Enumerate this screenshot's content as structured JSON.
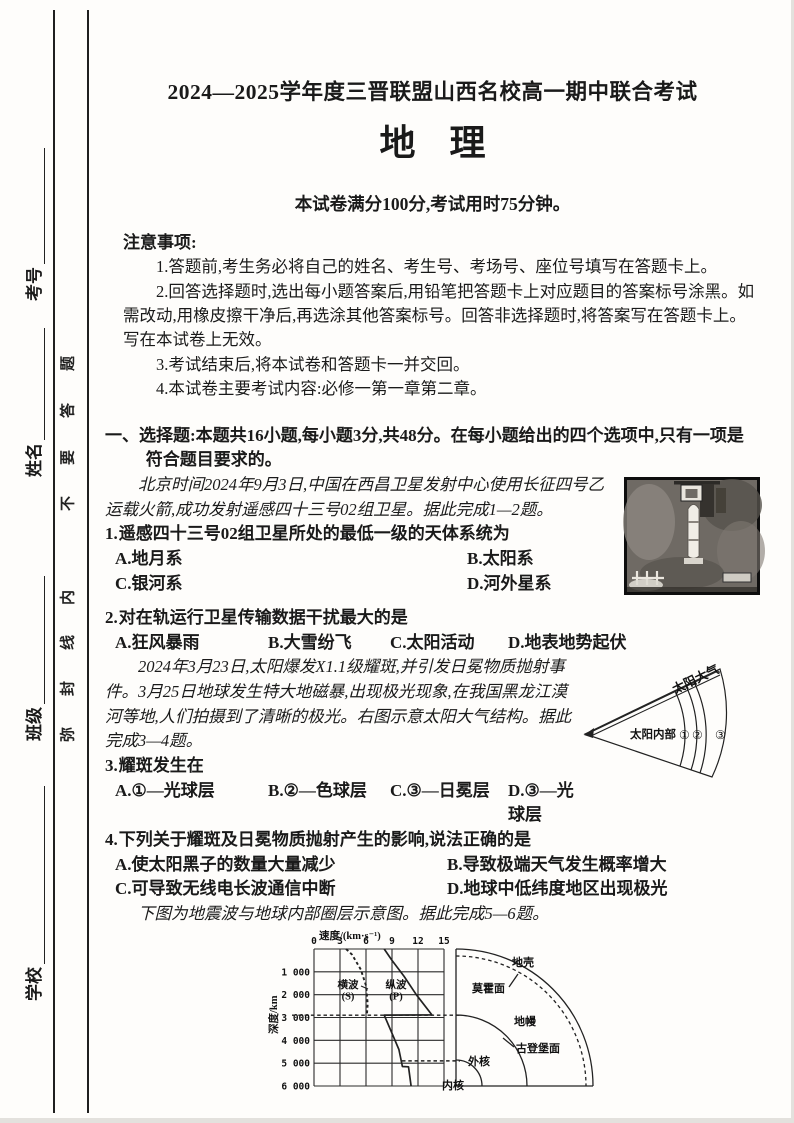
{
  "sidebar": {
    "seal_phrase": "弥封线内不要答题",
    "seal_chars": [
      "题",
      "答",
      "要",
      "不",
      "内",
      "线",
      "封",
      "弥"
    ],
    "fields": [
      {
        "label": "考号"
      },
      {
        "label": "姓名"
      },
      {
        "label": "班级"
      },
      {
        "label": "学校"
      }
    ]
  },
  "header": {
    "exam_title": "2024—2025学年度三晋联盟山西名校高一期中联合考试",
    "subject": "地理",
    "exam_info": "本试卷满分100分,考试用时75分钟。"
  },
  "notice": {
    "title": "注意事项:",
    "items": [
      "1.答题前,考生务必将自己的姓名、考生号、考场号、座位号填写在答题卡上。",
      "2.回答选择题时,选出每小题答案后,用铅笔把答题卡上对应题目的答案标号涂黑。如需改动,用橡皮擦干净后,再选涂其他答案标号。回答非选择题时,将答案写在答题卡上。写在本试卷上无效。",
      "3.考试结束后,将本试卷和答题卡一并交回。",
      "4.本试卷主要考试内容:必修一第一章第二章。"
    ]
  },
  "section": {
    "heading": "一、选择题:本题共16小题,每小题3分,共48分。在每小题给出的四个选项中,只有一项是符合题目要求的。"
  },
  "passages": [
    "北京时间2024年9月3日,中国在西昌卫星发射中心使用长征四号乙运载火箭,成功发射遥感四十三号02组卫星。据此完成1—2题。",
    "2024年3月23日,太阳爆发X1.1级耀斑,并引发日冕物质抛射事件。3月25日地球发生特大地磁暴,出现极光现象,在我国黑龙江漠河等地,人们拍摄到了清晰的极光。右图示意太阳大气结构。据此完成3—4题。",
    "下图为地震波与地球内部圈层示意图。据此完成5—6题。"
  ],
  "questions": [
    {
      "number": "1.",
      "stem": "遥感四十三号02组卫星所处的最低一级的天体系统为",
      "options": [
        "A.地月系",
        "B.太阳系",
        "C.银河系",
        "D.河外星系"
      ]
    },
    {
      "number": "2.",
      "stem": "对在轨运行卫星传输数据干扰最大的是",
      "options": [
        "A.狂风暴雨",
        "B.大雪纷飞",
        "C.太阳活动",
        "D.地表地势起伏"
      ]
    },
    {
      "number": "3.",
      "stem": "耀斑发生在",
      "options": [
        "A.①—光球层",
        "B.②—色球层",
        "C.③—日冕层",
        "D.③—光球层"
      ]
    },
    {
      "number": "4.",
      "stem": "下列关于耀斑及日冕物质抛射产生的影响,说法正确的是",
      "options": [
        "A.使太阳黑子的数量大量减少",
        "B.导致极端天气发生概率增大",
        "C.可导致无线电长波通信中断",
        "D.地球中低纬度地区出现极光"
      ]
    }
  ],
  "sun_diagram": {
    "label_atmosphere": "太阳大气",
    "label_interior": "太阳内部",
    "layers": [
      "①",
      "②",
      "③"
    ]
  },
  "chart_data": {
    "type": "line",
    "title": "地震波与地球内部圈层示意图",
    "xlabel": "速度/(km·s⁻¹)",
    "ylabel": "深度/km",
    "xlim": [
      0,
      15
    ],
    "ylim": [
      0,
      6000
    ],
    "x_ticks": [
      0,
      3,
      6,
      9,
      12,
      15
    ],
    "y_ticks": [
      1000,
      2000,
      3000,
      4000,
      5000,
      6000
    ],
    "y_tick_labels": [
      "1 000",
      "2 000",
      "3 000",
      "4 000",
      "5 000",
      "6 000"
    ],
    "grid": true,
    "series": [
      {
        "name": "横波(S)",
        "label_lines": [
          "横波",
          "(S)"
        ],
        "style": "dashed",
        "points": [
          [
            3.7,
            0
          ],
          [
            4.4,
            250
          ],
          [
            5.4,
            900
          ],
          [
            6.0,
            1600
          ],
          [
            6.2,
            2400
          ],
          [
            6.1,
            2885
          ]
        ]
      },
      {
        "name": "纵波(P)",
        "label_lines": [
          "纵波",
          "(P)"
        ],
        "style": "solid",
        "points": [
          [
            8.1,
            0
          ],
          [
            9.0,
            500
          ],
          [
            10.4,
            1200
          ],
          [
            11.8,
            2000
          ],
          [
            13.6,
            2885
          ],
          [
            8.1,
            2895
          ],
          [
            8.9,
            3600
          ],
          [
            9.8,
            4400
          ],
          [
            10.2,
            5145
          ],
          [
            10.9,
            5160
          ],
          [
            11.2,
            6000
          ]
        ]
      }
    ],
    "discontinuities": {
      "gutenberg_depth": 2900,
      "inner_core_depth": 4900
    },
    "earth_layers": {
      "crust": "地壳",
      "moho": "莫霍面",
      "mantle": "地幔",
      "gutenberg": "古登堡面",
      "outer_core": "外核",
      "inner_core": "内核"
    }
  },
  "footer": "【高一地理　第1页(共4页)】"
}
